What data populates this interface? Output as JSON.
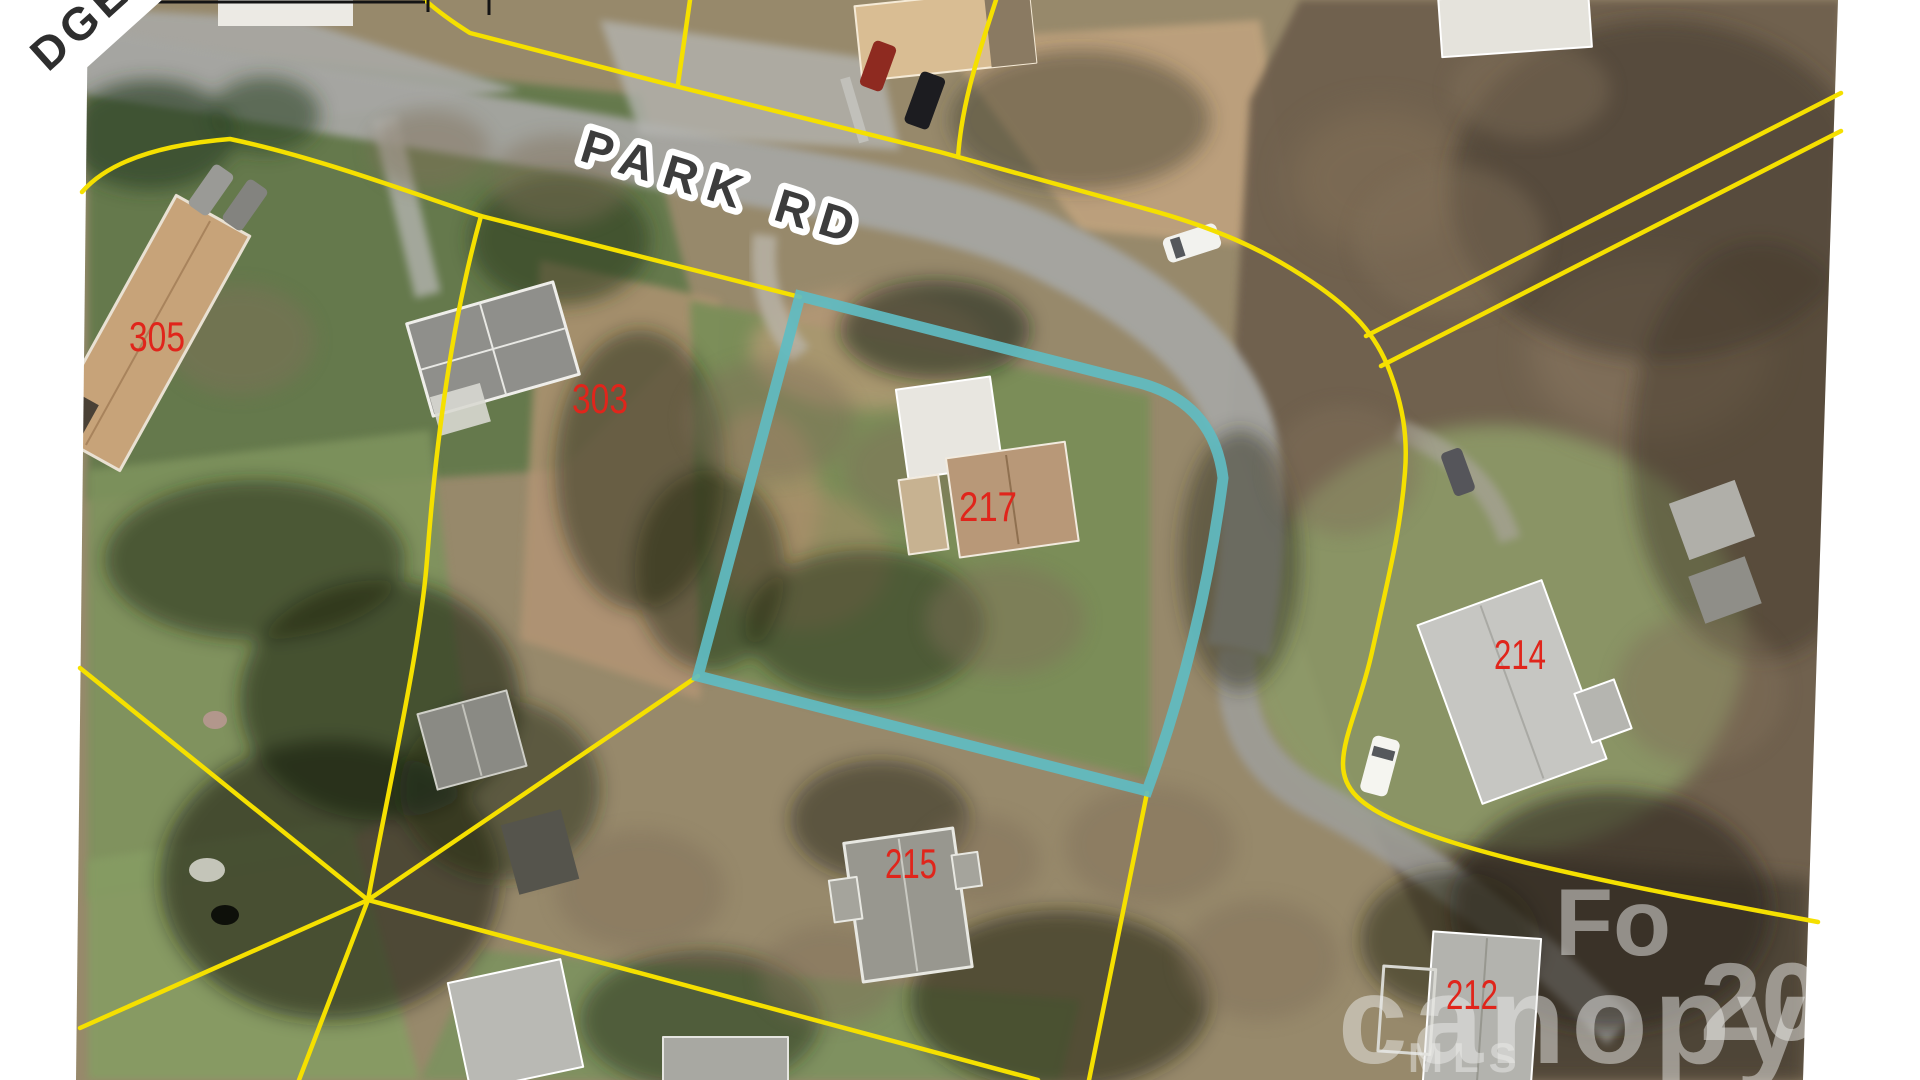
{
  "map": {
    "type": "aerial-parcel-map",
    "street_label": "PARK RD",
    "street_label_partial": "DGE",
    "subject_parcel": "217",
    "parcel_labels": {
      "p305": "305",
      "p303": "303",
      "p217": "217",
      "p215": "215",
      "p214": "214",
      "p212": "212"
    },
    "watermark": {
      "fragment_top": "Fo",
      "brand": "canopy",
      "mls": "MLS",
      "fragment_right": "20"
    },
    "colors": {
      "boundary_yellow": "#f5e000",
      "highlight_teal": "#5fbcc2",
      "label_red": "#e0251b",
      "street_label_fill": "#3c3c3c"
    }
  }
}
